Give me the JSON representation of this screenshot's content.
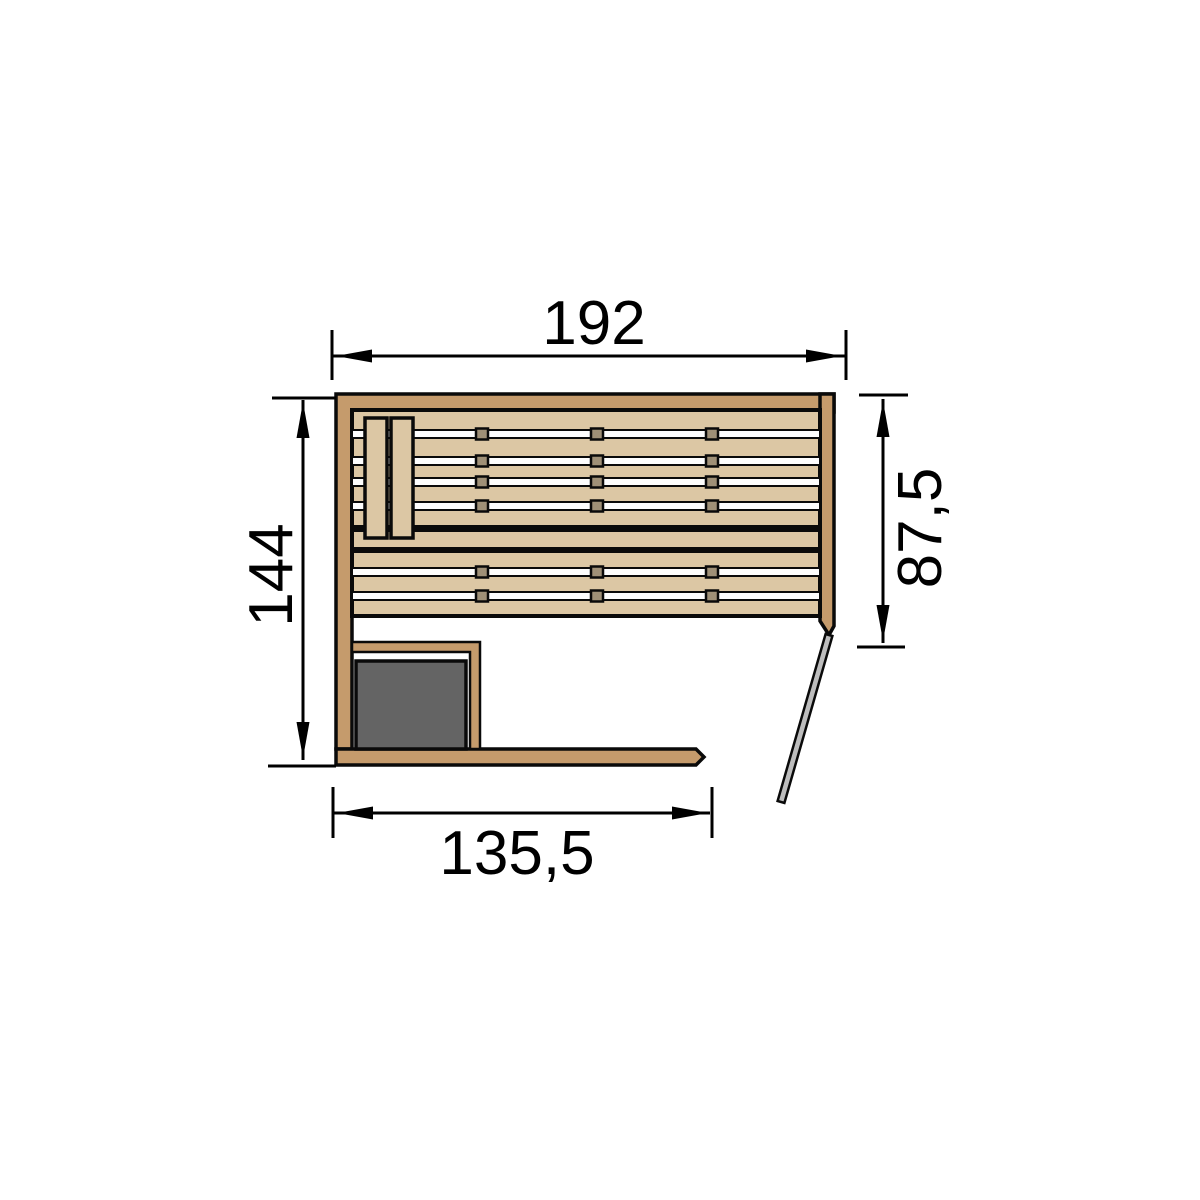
{
  "diagram": {
    "type": "sauna-floor-plan-top-view",
    "dimensions": {
      "top": {
        "label": "192"
      },
      "left": {
        "label": "144"
      },
      "right": {
        "label": "87,5"
      },
      "bottom": {
        "label": "135,5"
      }
    }
  },
  "colors": {
    "wall": "#c59b6c",
    "slat": "#dcc7a4",
    "gap": "#fdfdfd",
    "joint": "#9f9077",
    "heater": "#646464",
    "door": "#bdbdbd",
    "outline": "#0a0a0a",
    "dim": "#000000",
    "background": "#ffffff"
  }
}
